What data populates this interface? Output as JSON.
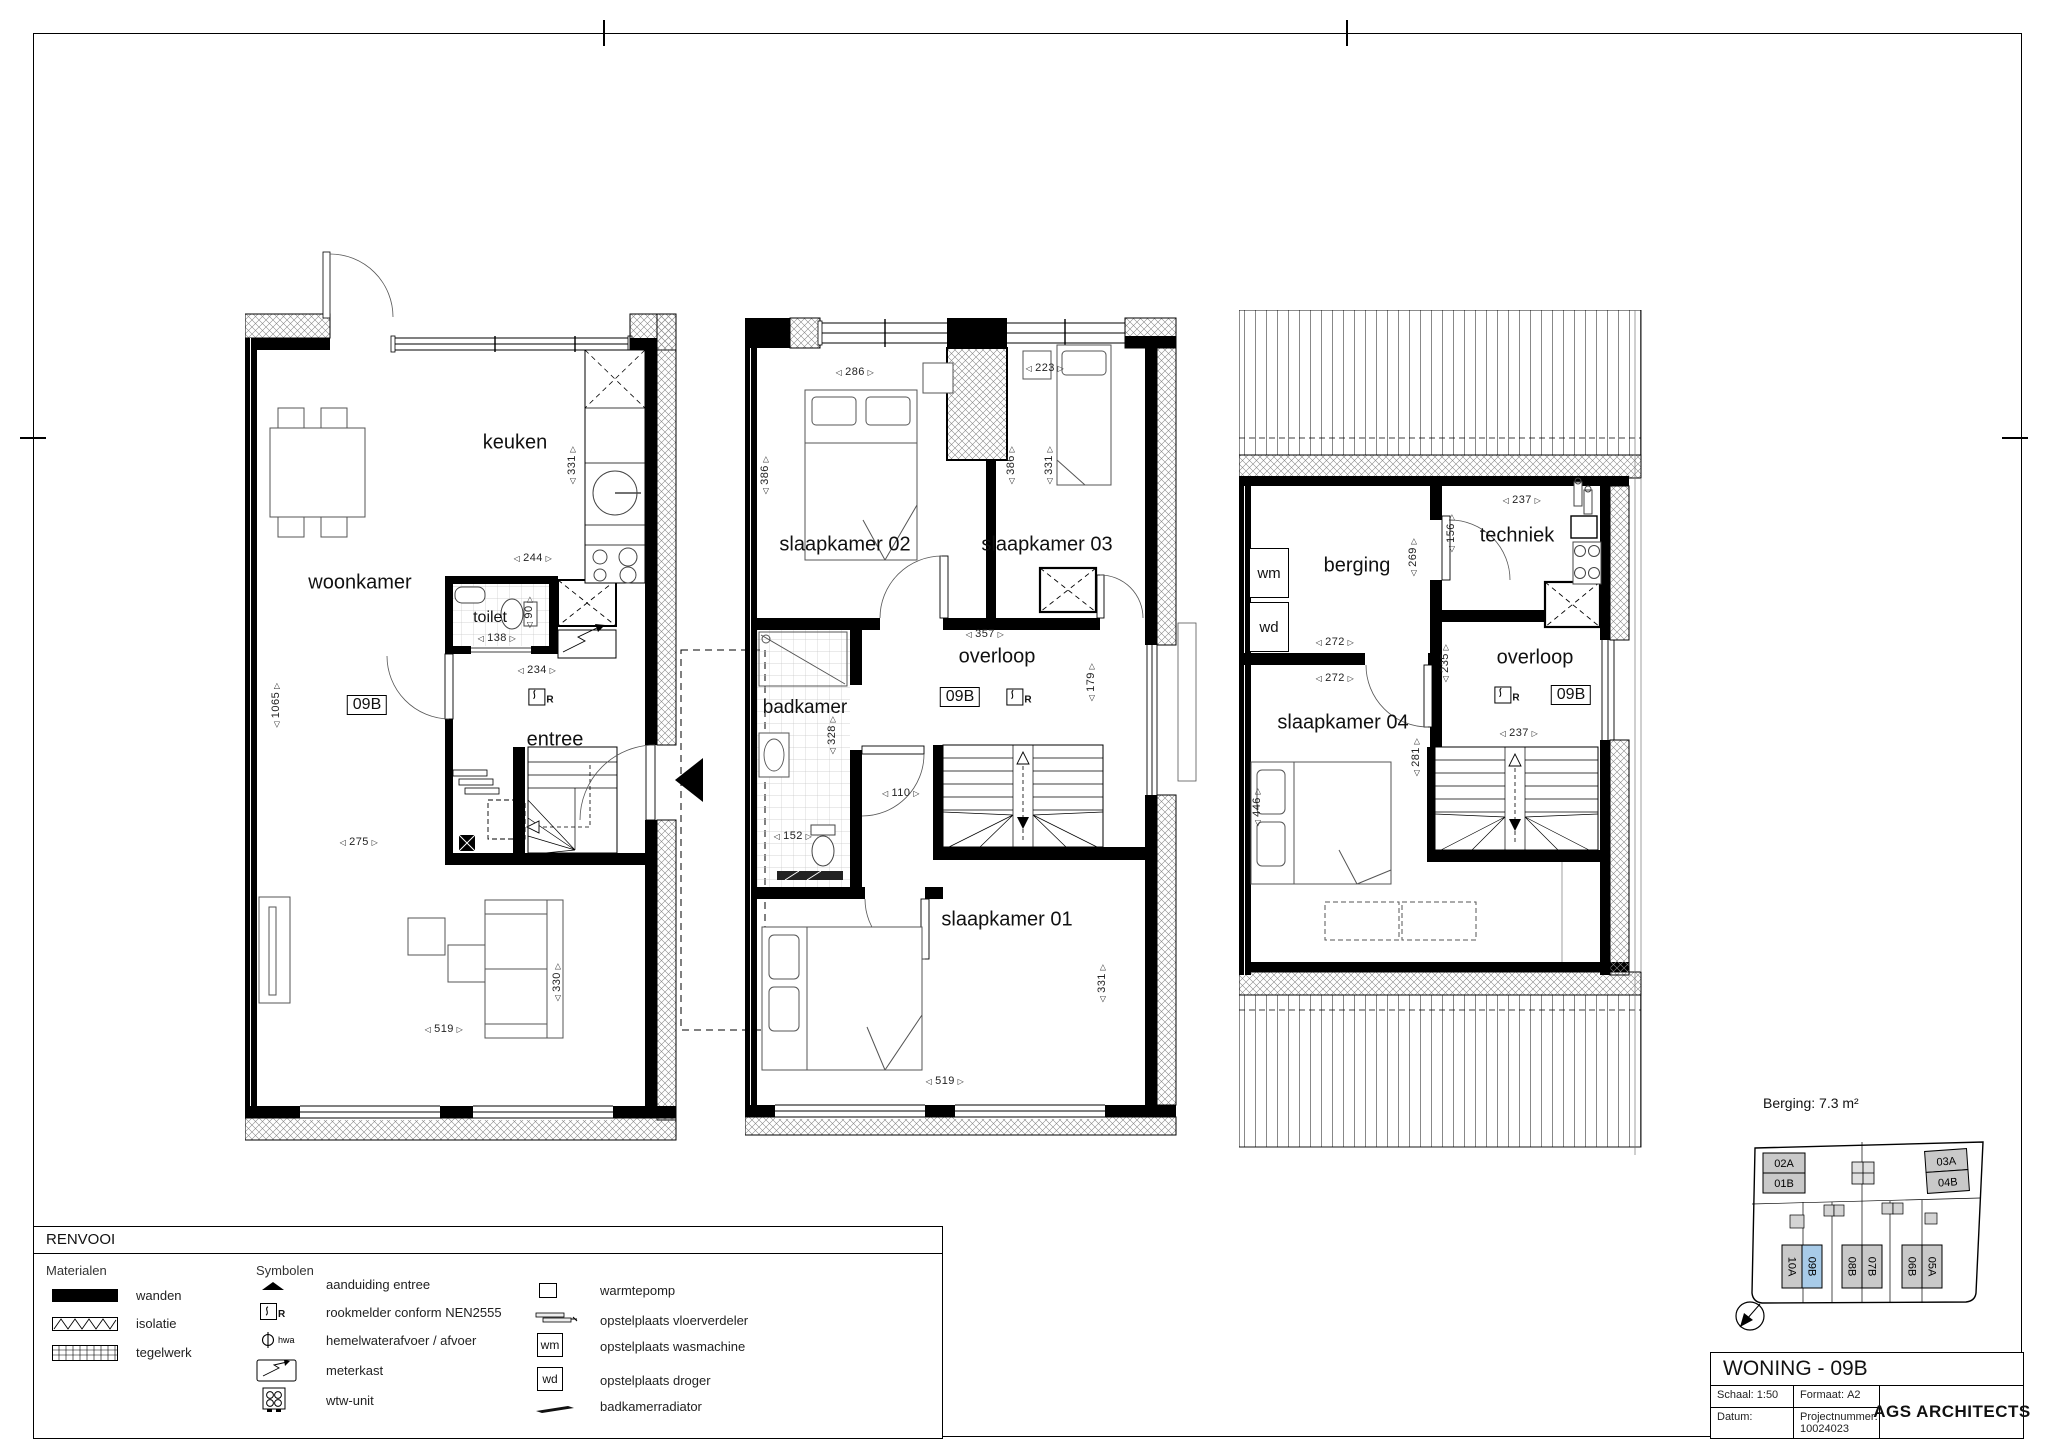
{
  "sheet": {
    "berging_note": "Berging: 7.3 m²"
  },
  "legend": {
    "title": "RENVOOI",
    "materials_header": "Materialen",
    "symbols_header": "Symbolen",
    "materials": [
      "wanden",
      "isolatie",
      "tegelwerk"
    ],
    "symbols1": [
      "aanduiding entree",
      "rookmelder conform NEN2555",
      "hemelwaterafvoer / afvoer",
      "meterkast",
      "wtw-unit"
    ],
    "symbols2": [
      "warmtepomp",
      "opstelplaats vloerverdeler",
      "opstelplaats wasmachine",
      "opstelplaats droger",
      "badkamerradiator"
    ],
    "hwa": "hwa",
    "wm": "wm",
    "wd": "wd",
    "r": "R"
  },
  "title_block": {
    "title": "WONING - 09B",
    "schaal_label": "Schaal:",
    "schaal": "1:50",
    "formaat_label": "Formaat:",
    "formaat": "A2",
    "datum_label": "Datum:",
    "project_label": "Projectnummer:",
    "project": "10024023",
    "firm": "AGS ARCHITECTS"
  },
  "site": {
    "t1": "02A",
    "t2": "01B",
    "t3": "03A",
    "t4": "04B",
    "b1": "10A",
    "b2": "09B",
    "b3": "08B",
    "b4": "07B",
    "b5": "06B",
    "b6": "05A",
    "highlight_color": "#a8cbe8"
  },
  "plans": {
    "ground": {
      "keuken": "keuken",
      "woonkamer": "woonkamer",
      "toilet": "toilet",
      "entree": "entree",
      "unit": "09B",
      "r": "R",
      "dims": {
        "d331": "331",
        "d244": "244",
        "d138": "138",
        "d90": "90",
        "d234": "234",
        "d1065": "1065",
        "d275": "275",
        "d519": "519",
        "d330": "330"
      }
    },
    "first": {
      "slk02": "slaapkamer 02",
      "slk03": "slaapkamer 03",
      "overloop": "overloop",
      "badkamer": "badkamer",
      "slk01": "slaapkamer 01",
      "unit": "09B",
      "r": "R",
      "dims": {
        "d286": "286",
        "d223": "223",
        "d386l": "386",
        "d386r": "386",
        "d331a": "331",
        "d357": "357",
        "d179": "179",
        "d110": "110",
        "d328": "328",
        "d152": "152",
        "d519": "519",
        "d331b": "331"
      }
    },
    "second": {
      "berging": "berging",
      "techniek": "techniek",
      "overloop": "overloop",
      "slk04": "slaapkamer 04",
      "wm": "wm",
      "wd": "wd",
      "unit": "09B",
      "r": "R",
      "dims": {
        "d237a": "237",
        "d156": "156",
        "d269": "269",
        "d272a": "272",
        "d272b": "272",
        "d235": "235",
        "d281": "281",
        "d237b": "237",
        "d446": "446"
      }
    }
  }
}
